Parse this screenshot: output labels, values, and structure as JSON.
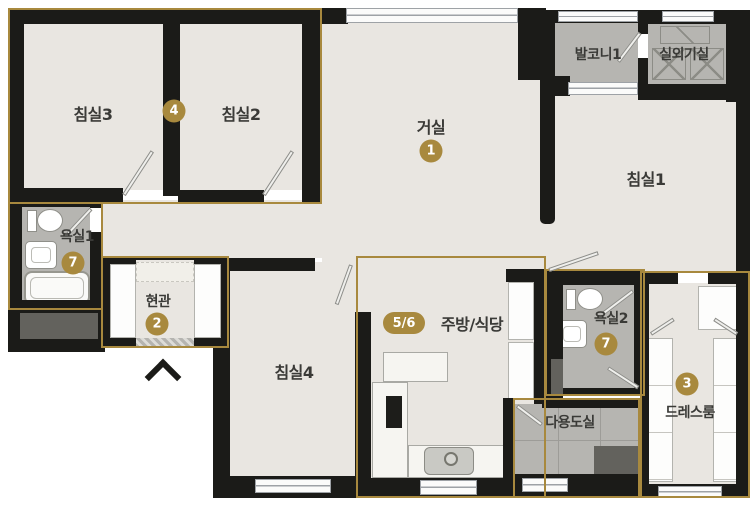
{
  "colors": {
    "accent_gold": "#a8893e",
    "wall": "#1b1b18",
    "floor": "#e9e6e1",
    "wet_floor": "#b6b5b1"
  },
  "rooms": {
    "bedroom3": {
      "label": "침실3"
    },
    "bedroom2": {
      "label": "침실2"
    },
    "bedrooms_wall": {
      "marker": "4"
    },
    "living": {
      "label": "거실",
      "marker": "1"
    },
    "balcony1": {
      "label": "발코니1"
    },
    "outdoor_unit": {
      "label": "실외기실"
    },
    "bedroom1": {
      "label": "침실1"
    },
    "bath1": {
      "label": "욕실1",
      "marker": "7"
    },
    "entrance": {
      "label": "현관",
      "marker": "2"
    },
    "bedroom4": {
      "label": "침실4"
    },
    "kitchen": {
      "label": "주방/식당",
      "marker": "5/6"
    },
    "bath2": {
      "label": "욕실2",
      "marker": "7"
    },
    "utility": {
      "label": "다용도실"
    },
    "dressroom": {
      "label": "드레스룸",
      "marker": "3"
    }
  }
}
